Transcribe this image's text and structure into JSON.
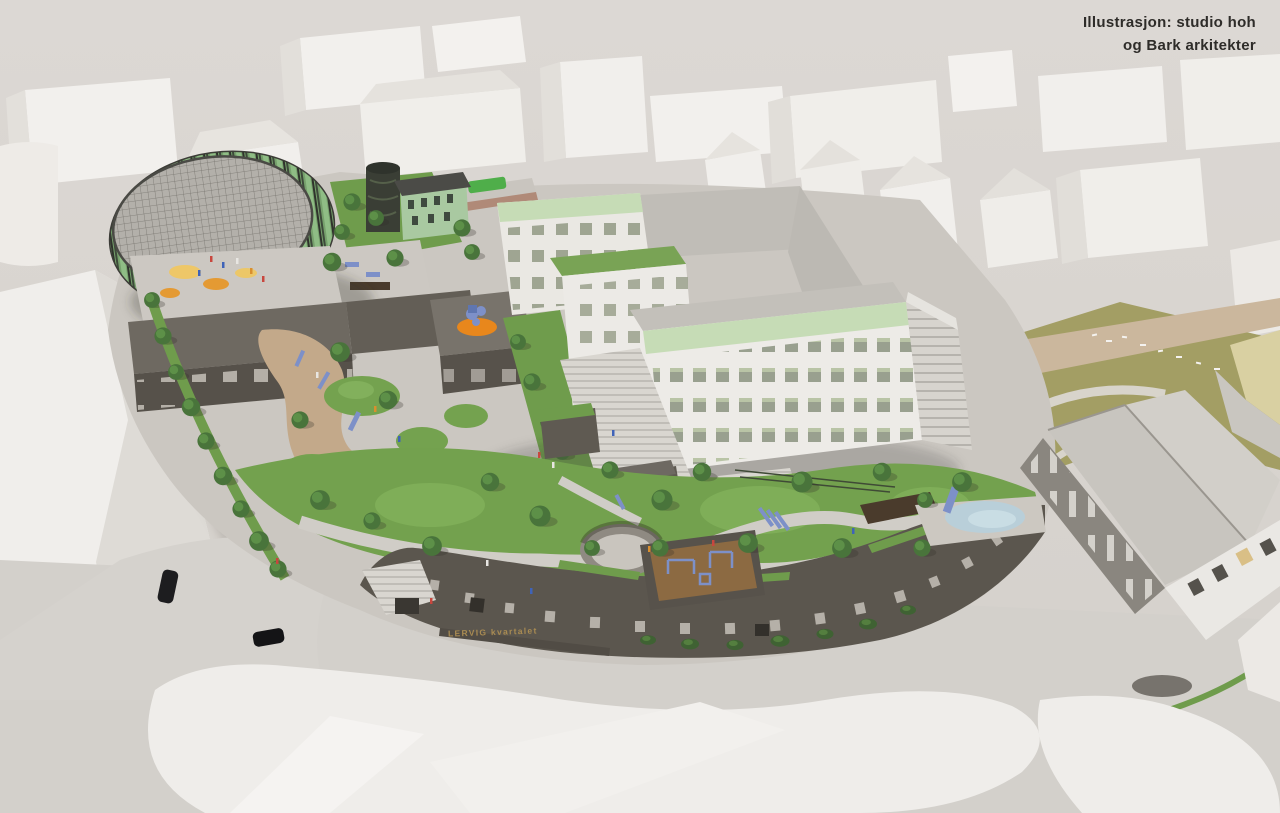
{
  "credit": {
    "line1": "Illustrasjon: studio hoh",
    "line2": "og Bark arkitekter"
  },
  "building_sign": {
    "text": "LERVIG kvartalet"
  },
  "palette": {
    "background": "#d8d4cf",
    "credit_text": "#2e2c29",
    "sign_gold": "#a98b52",
    "facade_green": "#8fbd85",
    "accent_band_green": "#c6dcb6",
    "lawn_green": "#73a14e",
    "brick_dark": "#57524b",
    "play_orange": "#e8871c",
    "play_blue": "#7d90c8",
    "pool_blue": "#b9cfd9",
    "context_white": "#efedea",
    "road_gray": "#d3d0cb",
    "olive_terrain": "#a39e64"
  }
}
